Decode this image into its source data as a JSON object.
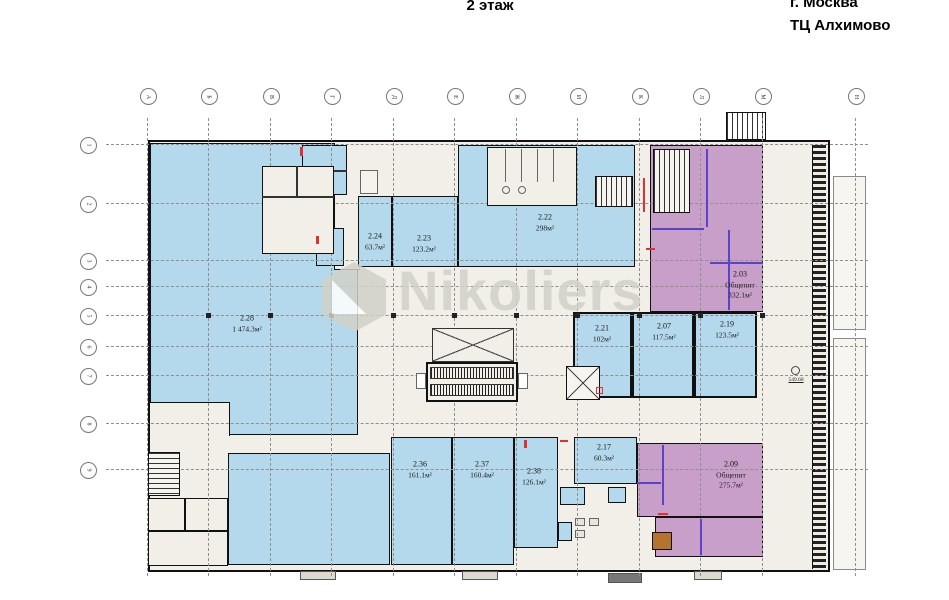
{
  "header": {
    "floor_title": "2 этаж",
    "city": "г. Москва",
    "building": "ТЦ Алхимово"
  },
  "watermark": {
    "text": "Nikoliers"
  },
  "axes": {
    "top": [
      "А",
      "Б",
      "В",
      "Г",
      "Д",
      "Е",
      "Ж",
      "И",
      "К",
      "Л",
      "М",
      "Н"
    ],
    "left": [
      "1",
      "2",
      "3",
      "4",
      "5",
      "6",
      "7",
      "8",
      "9"
    ]
  },
  "elevation_mark": {
    "value": "549.68"
  },
  "legend": {
    "retail_fill": "#b5d9ec",
    "food_fill": "#c89fc9",
    "floor_background": "#f2efe8",
    "wall_color": "#111111",
    "watermark_color": "#d0d0c9",
    "fire_accent": "#e03131",
    "partition_accent": "#5a43c8"
  },
  "rooms": {
    "r228": {
      "id": "2.28",
      "area": "1 474.3м²"
    },
    "r224": {
      "id": "2.24",
      "area": "63.7м²"
    },
    "r223": {
      "id": "2.23",
      "area": "123.2м²"
    },
    "r222": {
      "id": "2.22",
      "area": "298м²"
    },
    "r203": {
      "id": "2.03",
      "kind": "Общепит",
      "area": "332.1м²"
    },
    "r221": {
      "id": "2.21",
      "area": "102м²"
    },
    "r207": {
      "id": "2.07",
      "area": "117.5м²"
    },
    "r219": {
      "id": "2.19",
      "area": "123.5м²"
    },
    "r236": {
      "id": "2.36",
      "area": "161.1м²"
    },
    "r237": {
      "id": "2.37",
      "area": "160.4м²"
    },
    "r238": {
      "id": "2.38",
      "area": "126.1м²"
    },
    "r217": {
      "id": "2.17",
      "area": "60.3м²"
    },
    "r209": {
      "id": "2.09",
      "kind": "Общепит",
      "area": "275.7м²"
    }
  }
}
